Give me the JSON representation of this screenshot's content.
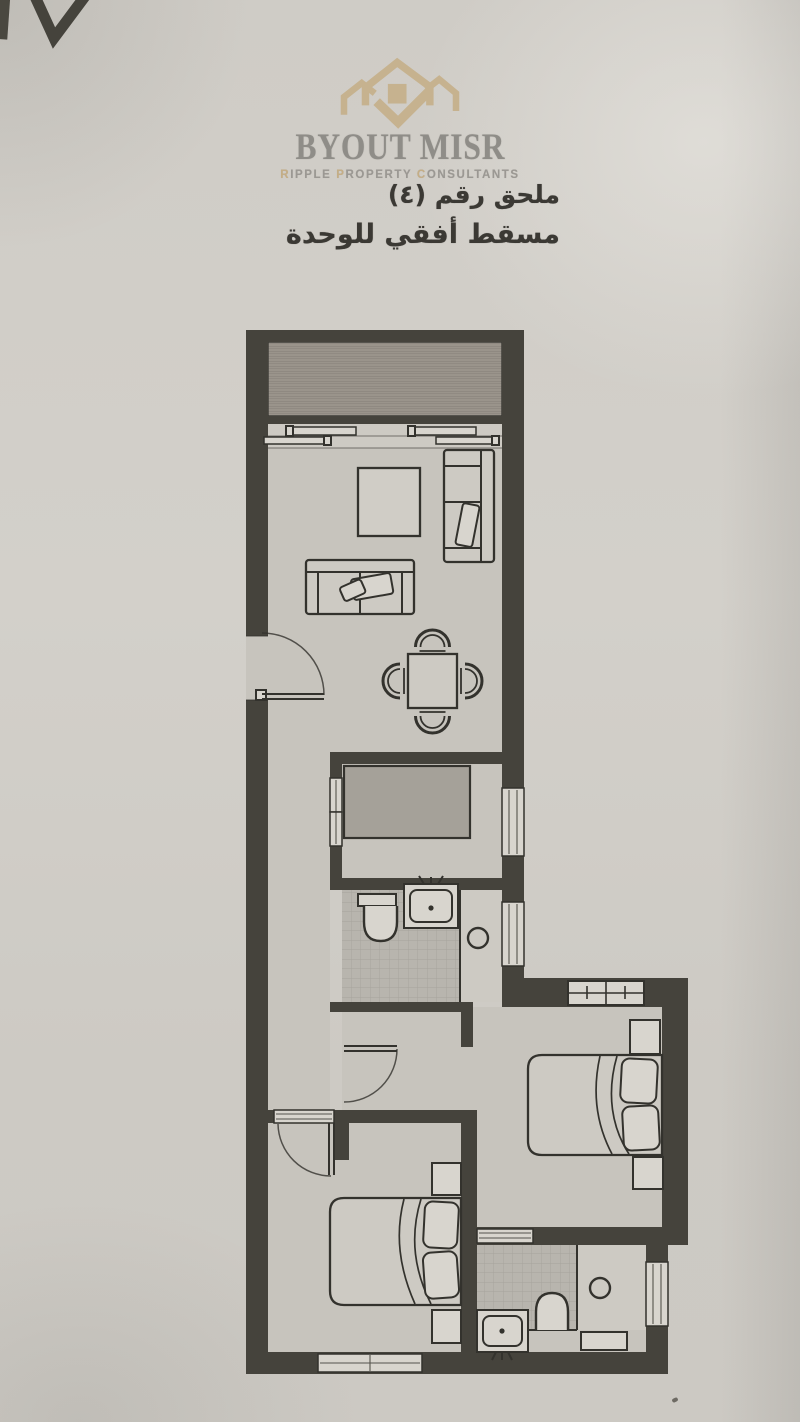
{
  "logo": {
    "brand": "BYOUT MISR",
    "tagline_words": [
      {
        "initial": "R",
        "rest": "IPPLE"
      },
      {
        "initial": "P",
        "rest": "ROPERTY"
      },
      {
        "initial": "C",
        "rest": "ONSULTANTS"
      }
    ]
  },
  "annex": {
    "line1": "ملحق رقم (٤)",
    "line2": "مسقط أفقي للوحدة"
  },
  "colors": {
    "paper": "#cfccc6",
    "wall": "#45433c",
    "ink": "#33322d",
    "floor": "#c7c4bd",
    "floor_light": "#cdcac3",
    "rug": "#d0cdc6",
    "window_fill": "#d8d5ce",
    "tile": "#b8b5ae",
    "tile_line": "#a6a39c",
    "balcony": "#9a948b",
    "balcony_line": "#8b857d",
    "counter": "#a5a199",
    "gold": "#c5ae86",
    "brand_gray": "#8f8d88",
    "tagline_gray": "#9b9893",
    "text_dark": "#3b3934"
  }
}
